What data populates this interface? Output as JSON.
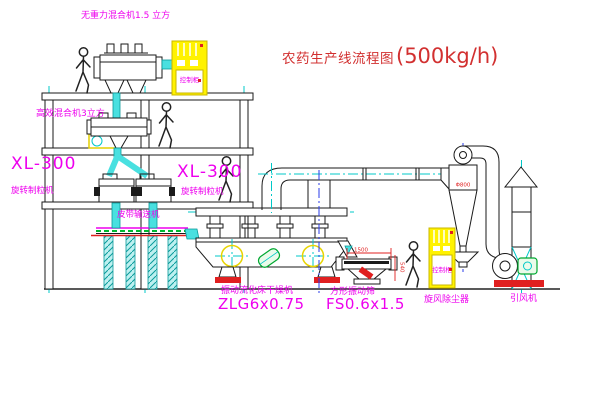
{
  "title": {
    "text_cn": "农药生产线流程图",
    "text_capacity": "(500kg/h)"
  },
  "equipment_labels": {
    "gravity_mixer": "无重力混合机1.5 立方",
    "high_eff_mixer": "高效混合机3立方",
    "granulator_left_model": "XL-300",
    "granulator_left_name": "旋转制粒机",
    "granulator_right_model": "XL-300",
    "granulator_right_name": "旋转制粒机",
    "belt_conveyor": "皮带输送机",
    "fluid_bed_dryer_name": "振动流化床干燥机",
    "fluid_bed_dryer_model": "ZLG6x0.75",
    "vibrating_screen_name": "方形振动筛",
    "vibrating_screen_model": "FS0.6x1.5",
    "cyclone": "旋风除尘器",
    "induced_draft_fan": "引风机"
  },
  "cabinet_labels": {
    "cabinet1": "控制柜",
    "cabinet2": "控制柜"
  },
  "dimensions": {
    "screen_length": "1500",
    "screen_height": "540",
    "cyclone_inlet": "Φ800"
  },
  "colors": {
    "label_magenta": "#EE00EE",
    "title_red": "#D23030",
    "line_black": "#1A1A1A",
    "centerline_cyan": "#00C8C8",
    "centerline_blue": "#2A3BE8",
    "pipe_cyan": "#49E0E0",
    "cad_yellow": "#FFF200",
    "dim_red": "#E02020",
    "motor_green": "#00A830"
  }
}
